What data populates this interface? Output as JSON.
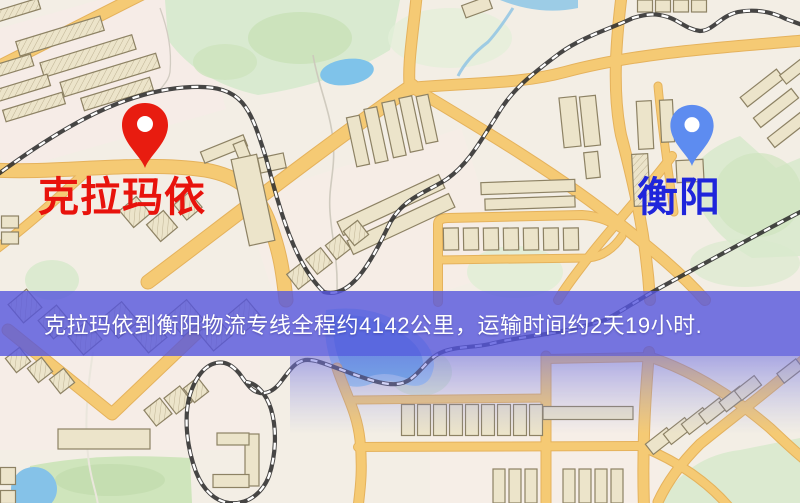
{
  "banner": {
    "text": "克拉玛依到衡阳物流专线全程约4142公里，运输时间约2天19小时.",
    "bg_color": "rgba(85,85,221,0.8)",
    "text_color": "#ffffff"
  },
  "markers": {
    "origin": {
      "label": "克拉玛依",
      "pin_color": "#e81c10",
      "label_color": "#e8130c"
    },
    "destination": {
      "label": "衡阳",
      "pin_color": "#5d8cf0",
      "label_color": "#1f25db"
    }
  },
  "route": {
    "origin": "克拉玛依",
    "destination": "衡阳",
    "distance_text": "约4142公里",
    "duration_text": "约2天19小时"
  },
  "map_colors": {
    "background": "#f3eee5",
    "road": "#f5ca74",
    "road_edge": "#e8b55e",
    "water": "#7fc0e8",
    "park": "#d8e9cc",
    "railway": "#2e2e2e",
    "building": "#ece4ca"
  }
}
